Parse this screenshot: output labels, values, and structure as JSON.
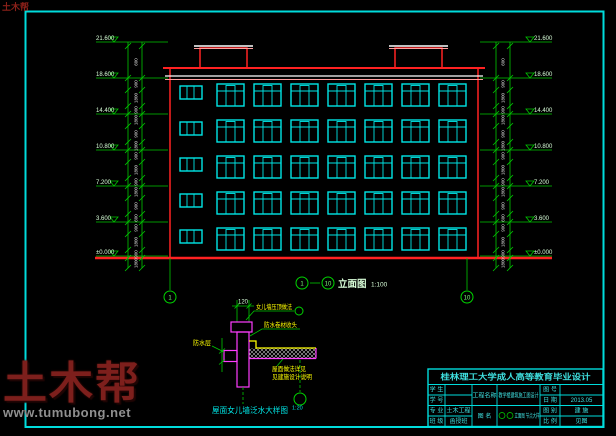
{
  "corner_watermark": "土木帮",
  "watermark": {
    "brand": "土木帮",
    "url": "www.tumubong.net"
  },
  "colors": {
    "background": "#000000",
    "frame": "#00dcdc",
    "building_outline": "#ff2222",
    "window": "#00e6e6",
    "dimension_lines": "#00c800",
    "detail_wall": "#ff3dff",
    "detail_slab_edge": "#ffff00",
    "annotation_text": "#ffff00",
    "titleblock_text": "#3fe0e0",
    "cornice_line1": "#ffffff",
    "cornice_line2": "#ff9e9e",
    "watermark_brand": "#7d1f1c",
    "watermark_url": "#909090"
  },
  "elevation_view": {
    "axis_start": "1",
    "axis_end": "10",
    "caption": "立面图",
    "scale": "1:100",
    "floors": 5,
    "window_columns": 8,
    "left_levels": [
      "21.600",
      "18.600",
      "14.400",
      "10.800",
      "7.200",
      "3.600",
      "±0.000"
    ],
    "right_levels": [
      "21.600",
      "18.600",
      "14.400",
      "10.800",
      "7.200",
      "3.600",
      "±0.000"
    ],
    "chain_dimensions": [
      "600",
      "900",
      "1800",
      "900",
      "1800",
      "900",
      "1800",
      "900",
      "1800",
      "900",
      "1800",
      "900"
    ],
    "axis_bubbles": [
      "1",
      "10"
    ]
  },
  "detail_view": {
    "top_dimension": "120",
    "annotations": {
      "a1": "女儿墙压顶做法",
      "a2": "防水卷材收头",
      "a3_line1": "屋面做法详见",
      "a3_line2": "见建施设计说明",
      "left": "防水层"
    },
    "caption": "屋面女儿墙泛水大样图",
    "scale": "1:20"
  },
  "title_block": {
    "title": "桂林理工大学成人高等教育毕业设计",
    "r1": {
      "l1": "学 生",
      "v1": "",
      "l2": "工程名称",
      "v2": "教学楼建筑施工图设计",
      "l3": "图 号",
      "v3": ""
    },
    "r2": {
      "l1": "学 号",
      "v1": "",
      "l3": "日 期",
      "v3": "2013.05"
    },
    "r3": {
      "l1": "专 业",
      "v1": "土木工程",
      "l2": "图 名",
      "v2": "立面图 节点大样",
      "l3": "图 别",
      "v3": "建 施"
    },
    "r4": {
      "l1": "班 级",
      "v1": "函授班",
      "l3": "比 例",
      "v3": "见图"
    },
    "drawing_name_axis": [
      "1",
      "10"
    ]
  }
}
